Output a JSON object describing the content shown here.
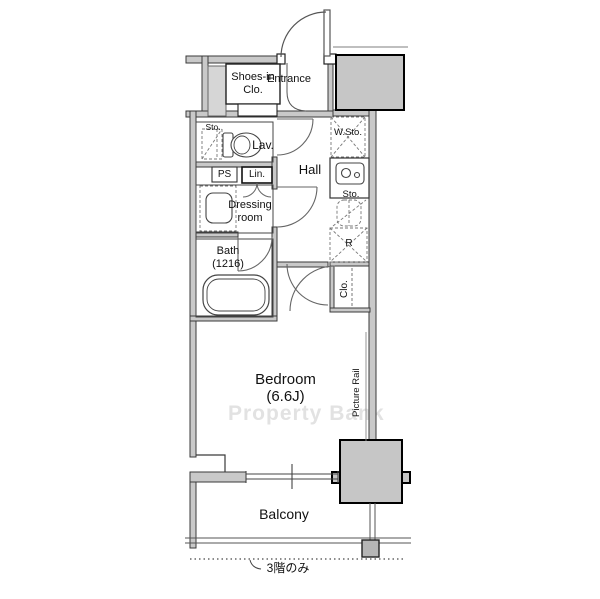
{
  "plan": {
    "rooms": {
      "entrance": "Entrance",
      "shoes_in_closet": "Shoes-in Clo.",
      "lavatory": "Lav.",
      "hall": "Hall",
      "dressing_room": "Dressing room",
      "bath": "Bath (1216)",
      "bedroom": "Bedroom (6.6J)",
      "balcony": "Balcony",
      "closet": "Clo."
    },
    "labels": {
      "storage_lav": "Sto.",
      "pipe_space": "PS",
      "linen": "Lin.",
      "wide_storage": "W.Sto.",
      "storage_kitchen": "Sto.",
      "refrigerator": "R",
      "picture_rail": "Picture Rail"
    },
    "notes": {
      "floor_note": "3階のみ"
    },
    "watermark": "Property Bank",
    "colors": {
      "wall_fill": "#c9c9c9",
      "pillar_fill": "#c6c6c6",
      "line": "#3a3a3a",
      "dashed_line": "#777777",
      "watermark": "#e2e2e2"
    }
  }
}
